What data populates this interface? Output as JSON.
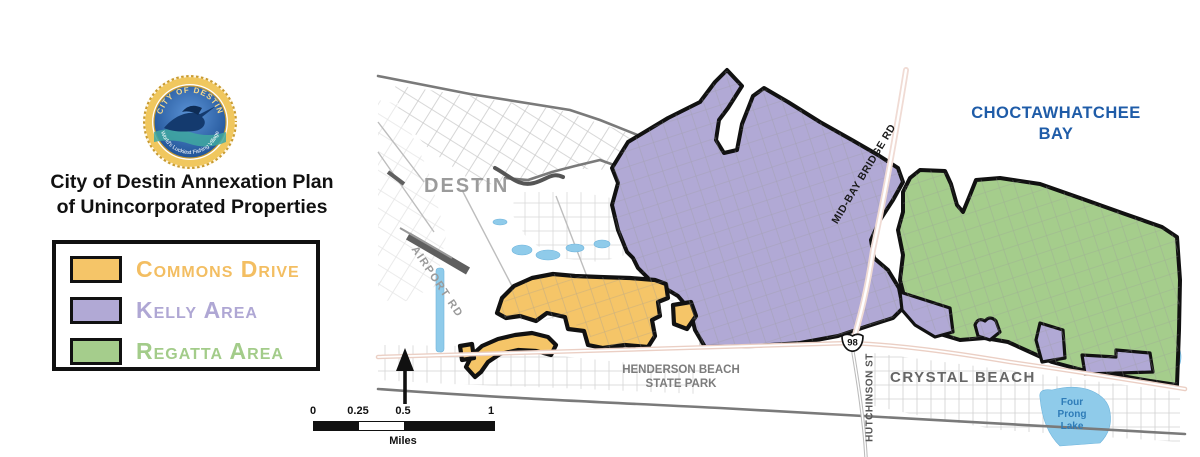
{
  "branding": {
    "seal_top_text": "CITY OF DESTIN",
    "seal_bottom_text": "World's Luckiest Fishing Village"
  },
  "title": {
    "line1": "City of Destin Annexation Plan",
    "line2": "of Unincorporated Properties"
  },
  "legend": {
    "items": [
      {
        "label": "Commons Drive",
        "color": "#F3BE62"
      },
      {
        "label": "Kelly Area",
        "color": "#AFA7D4"
      },
      {
        "label": "Regatta Area",
        "color": "#A3CC8A"
      }
    ]
  },
  "map": {
    "labels": {
      "city": "DESTIN",
      "bay_line1": "CHOCTAWHATCHEE",
      "bay_line2": "BAY",
      "state_park_line1": "HENDERSON BEACH",
      "state_park_line2": "STATE PARK",
      "crystal_beach": "CRYSTAL BEACH",
      "mid_bay_bridge_rd": "MID-BAY BRIDGE RD",
      "hutchinson_st": "HUTCHINSON ST",
      "airport_rd": "AIRPORT RD",
      "lake_line1": "Four",
      "lake_line2": "Prong",
      "lake_line3": "Lake",
      "route_shield": "98"
    },
    "colors": {
      "commons": "#F5C568",
      "kelly": "#B1A9D5",
      "regatta": "#A5CD8C",
      "bay_label": "#1F5CA8",
      "water": "#8FCBEA"
    },
    "scale_bar": {
      "ticks": [
        "0",
        "0.25",
        "0.5",
        "1"
      ],
      "unit": "Miles"
    }
  }
}
